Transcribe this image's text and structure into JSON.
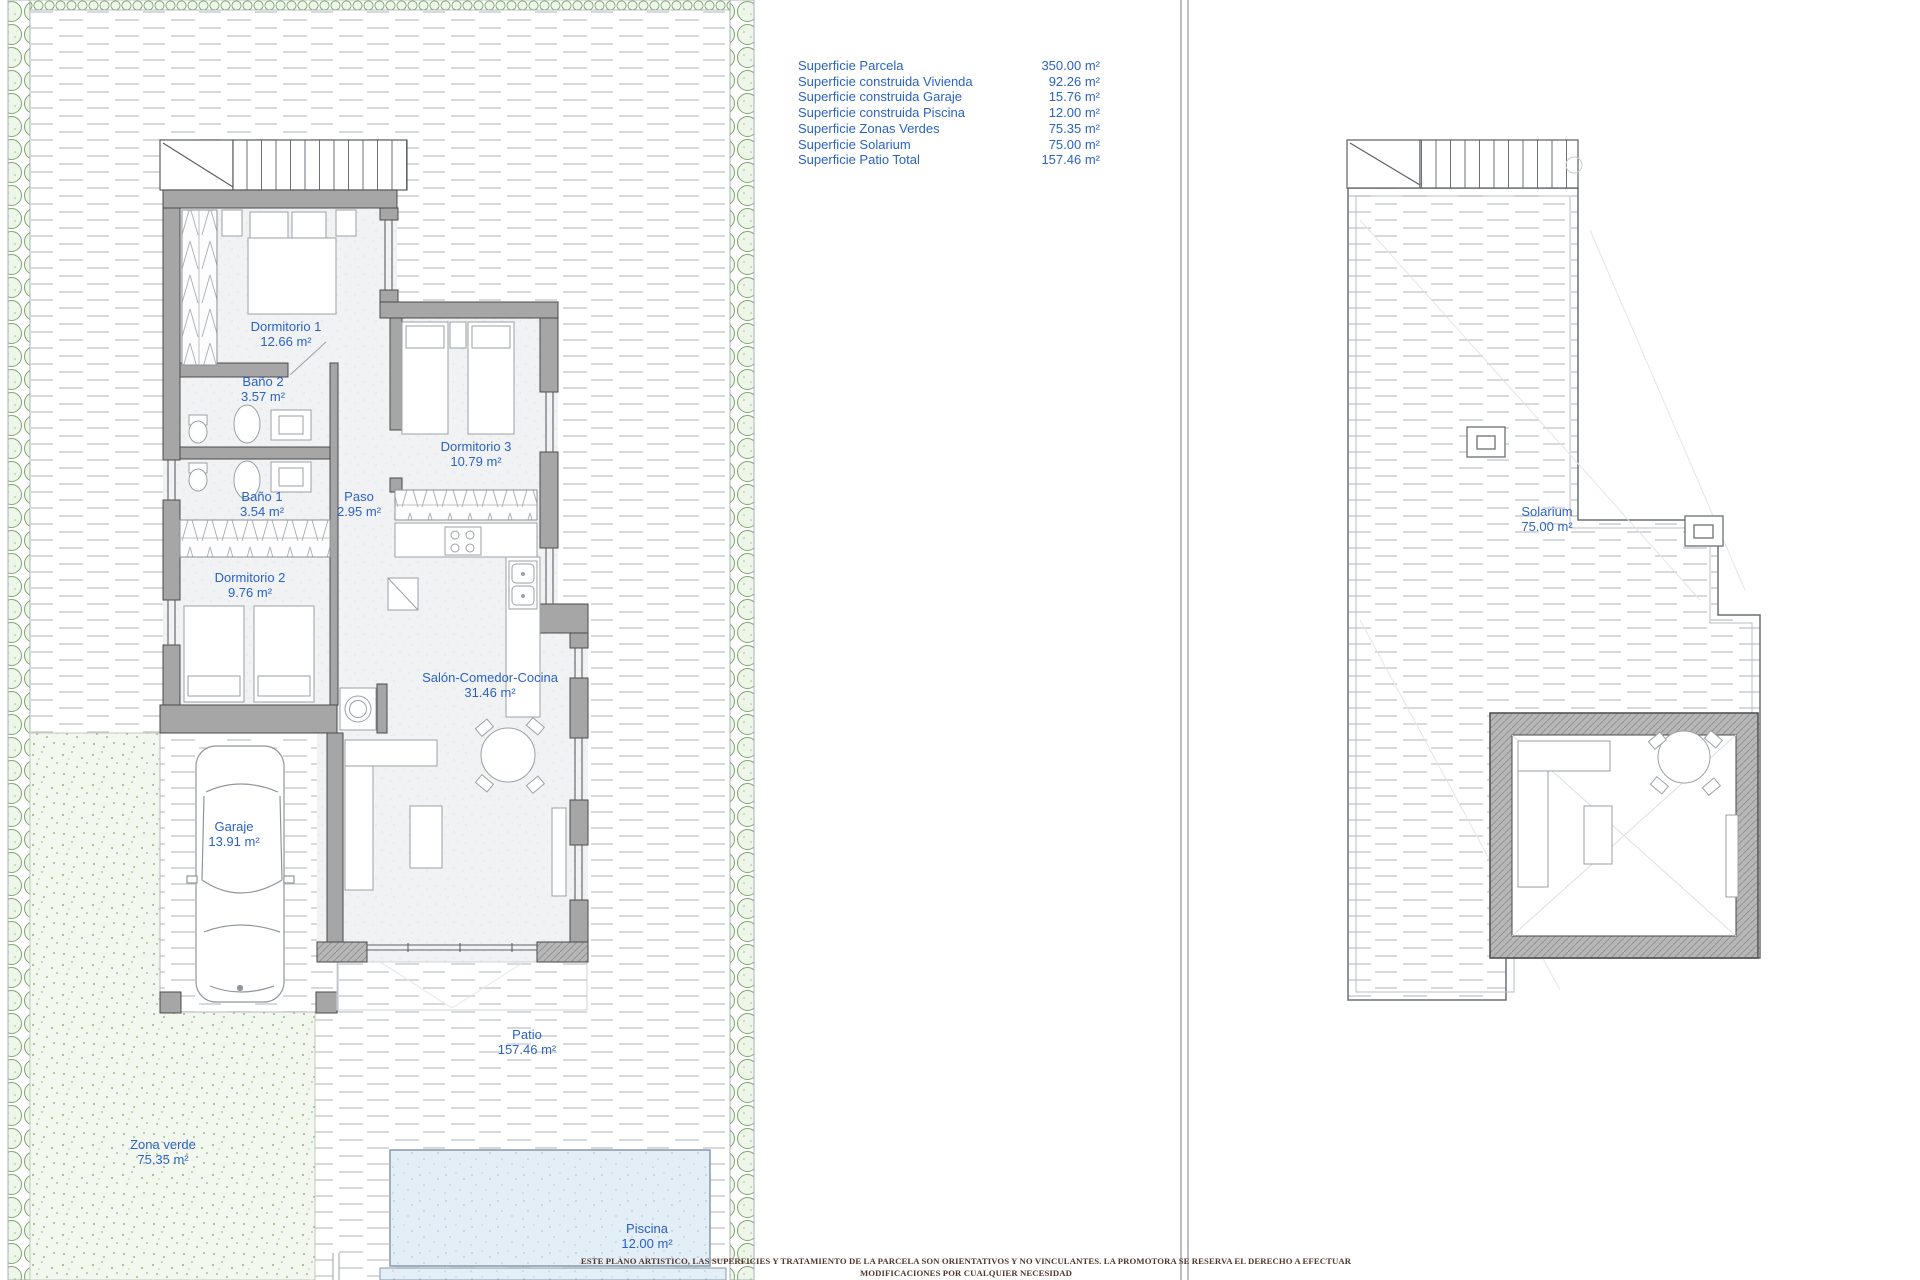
{
  "summary": {
    "rows": [
      {
        "label": "Superficie Parcela",
        "value": "350.00 m²"
      },
      {
        "label": "Superficie construida Vivienda",
        "value": "92.26 m²"
      },
      {
        "label": "Superficie construida Garaje",
        "value": "15.76 m²"
      },
      {
        "label": "Superficie construida Piscina",
        "value": "12.00 m²"
      },
      {
        "label": "Superficie Zonas Verdes",
        "value": "75.35 m²"
      },
      {
        "label": "Superficie Solarium",
        "value": "75.00 m²"
      },
      {
        "label": "Superficie Patio Total",
        "value": "157.46 m²"
      }
    ]
  },
  "rooms": {
    "dormitorio1": {
      "name": "Dormitorio 1",
      "area": "12.66 m²"
    },
    "bano2": {
      "name": "Baño 2",
      "area": "3.57 m²"
    },
    "dormitorio3": {
      "name": "Dormitorio 3",
      "area": "10.79 m²"
    },
    "bano1": {
      "name": "Baño 1",
      "area": "3.54 m²"
    },
    "paso": {
      "name": "Paso",
      "area": "2.95 m²"
    },
    "dormitorio2": {
      "name": "Dormitorio 2",
      "area": "9.76 m²"
    },
    "garaje": {
      "name": "Garaje",
      "area": "13.91 m²"
    },
    "salon": {
      "name": "Salón-Comedor-Cocina",
      "area": "31.46 m²"
    },
    "patio": {
      "name": "Patio",
      "area": "157.46 m²"
    },
    "zonaverde": {
      "name": "Zona verde",
      "area": "75.35 m²"
    },
    "piscina": {
      "name": "Piscina",
      "area": "12.00 m²"
    },
    "solarium": {
      "name": "Solarium",
      "area": "75.00 m²"
    }
  },
  "disclaimer": {
    "es": "ESTE PLANO ARTISTICO, LAS SUPERFICIES Y TRATAMIENTO DE LA PARCELA SON ORIENTATIVOS Y NO VINCULANTES. LA PROMOTORA SE RESERVA EL DERECHO A EFECTUAR MODIFICACIONES POR CUALQUIER NECESIDAD",
    "en": "THIS ARTISTIC PLAN, THE SURFACES AND THE TREATMENT OF THE PLOT ARE ILLUSTRATIVE AND NON-CONTRACTUAL. THE PROMOTER RESERVES THE RIGHT OF MAKING CHANGES DUE TO ANY NECESSITY"
  },
  "colors": {
    "label_blue": "#2a62c6",
    "wall_gray": "#a6a6a6",
    "hedge_green": "#7aa66b",
    "grass_green": "#8fb77c",
    "pool_blue": "#e4eef7",
    "disclaimer_brown": "#50372a"
  }
}
